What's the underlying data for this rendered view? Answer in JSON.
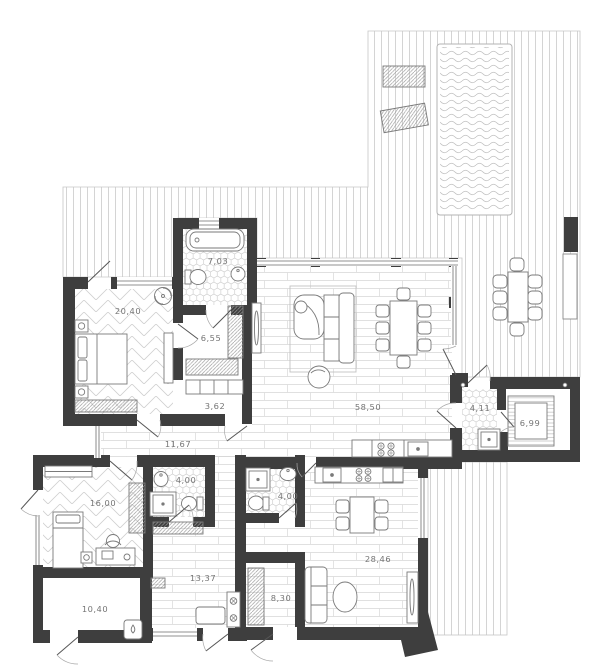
{
  "floor_plan": {
    "palette": {
      "wall_color": "#3e3e3e",
      "floor_line_color": "#cdcdcd",
      "fixture_line_color": "#7a7a7a",
      "label_color": "#757575"
    },
    "rooms": [
      {
        "name": "master-bedroom",
        "area": "20,40"
      },
      {
        "name": "bathroom",
        "area": "7,03"
      },
      {
        "name": "walk-in-closet",
        "area": "6,55"
      },
      {
        "name": "hall",
        "area": "3,62"
      },
      {
        "name": "living-dining-kitchen",
        "area": "58,50"
      },
      {
        "name": "corridor",
        "area": "11,67"
      },
      {
        "name": "bedroom-2",
        "area": "16,00"
      },
      {
        "name": "shower-room",
        "area": "4,00"
      },
      {
        "name": "utility-room",
        "area": "10,40"
      },
      {
        "name": "hallway",
        "area": "13,37"
      },
      {
        "name": "guest-shower-room",
        "area": "4,00"
      },
      {
        "name": "guest-entry",
        "area": "8,30"
      },
      {
        "name": "guest-living-kitchen",
        "area": "28,46"
      },
      {
        "name": "sauna-vestibule",
        "area": "4,11"
      },
      {
        "name": "sauna",
        "area": "6,99"
      }
    ]
  }
}
